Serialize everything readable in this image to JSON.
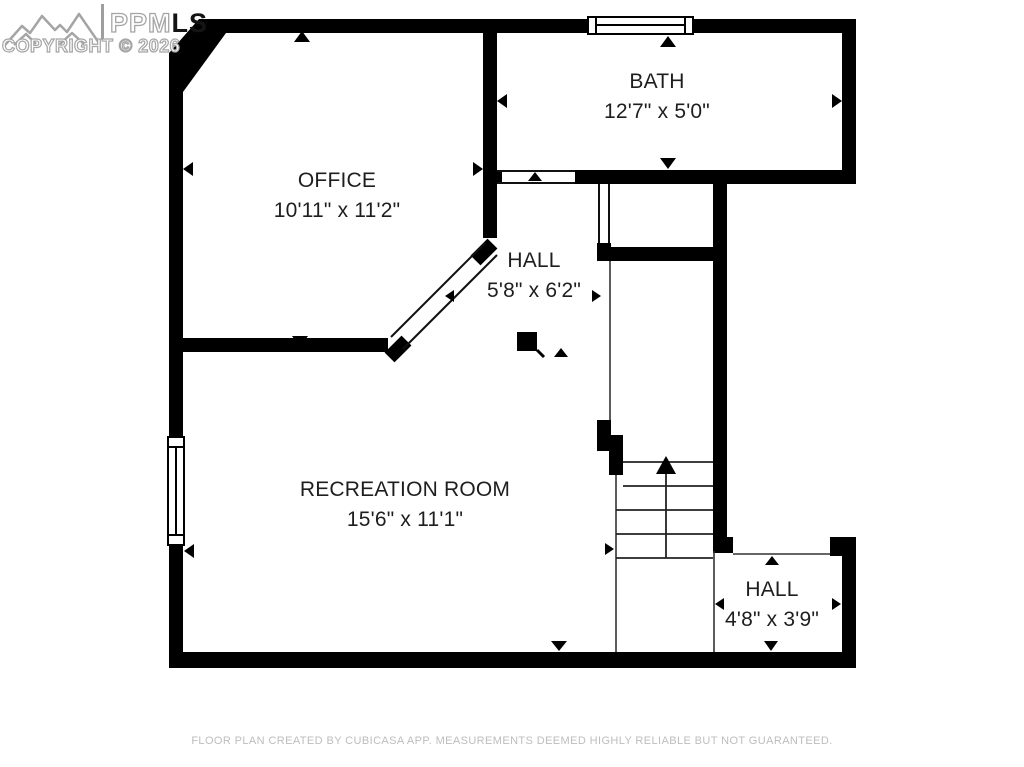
{
  "watermark": {
    "logo": "mountain-range-icon",
    "brand_outline": "PPM",
    "brand_solid": "LS",
    "copyright_line": "COPYRIGHT © 2026"
  },
  "rooms": {
    "office": {
      "name": "OFFICE",
      "dims": "10'11\" x 11'2\""
    },
    "bath": {
      "name": "BATH",
      "dims": "12'7\" x 5'0\""
    },
    "hall": {
      "name": "HALL",
      "dims": "5'8\" x 6'2\""
    },
    "recreation": {
      "name": "RECREATION ROOM",
      "dims": "15'6\" x 11'1\""
    },
    "hall_lower": {
      "name": "HALL",
      "dims": "4'8\" x 3'9\""
    }
  },
  "stairs": {
    "direction": "up"
  },
  "footer": {
    "disclaimer": "FLOOR PLAN CREATED BY CUBICASA APP. MEASUREMENTS DEEMED HIGHLY RELIABLE BUT NOT GUARANTEED."
  },
  "colors": {
    "wall": "#000000",
    "room_text": "#1e1e1e",
    "footer_text": "#bdbdbd",
    "watermark_gray": "#a5a5a5",
    "background": "#ffffff"
  }
}
